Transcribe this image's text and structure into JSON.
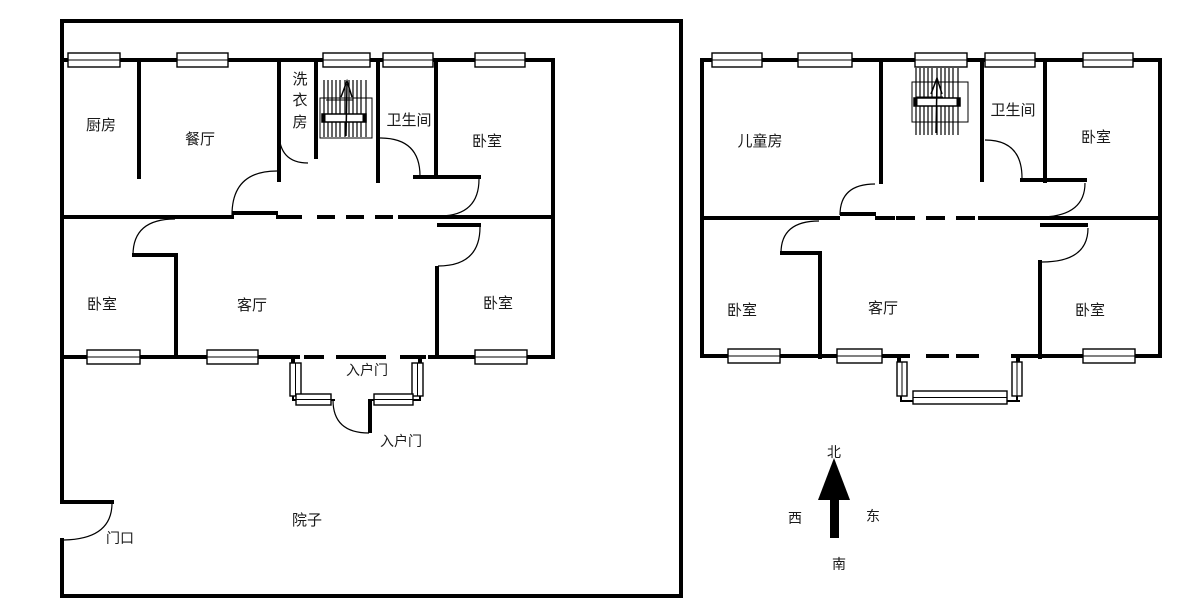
{
  "page": {
    "background": "#ffffff",
    "line_color": "#000000",
    "text_color": "#1a1a1a"
  },
  "left_plan": {
    "rooms": {
      "kitchen": "厨房",
      "dining": "餐厅",
      "laundry_chars": [
        "洗",
        "衣",
        "房"
      ],
      "bathroom": "卫生间",
      "bedroom_top": "卧室",
      "bedroom_left": "卧室",
      "living": "客厅",
      "bedroom_right": "卧室",
      "courtyard": "院子",
      "gate": "门口",
      "entrance_door_top": "入户门",
      "entrance_door_bottom": "入户门"
    }
  },
  "right_plan": {
    "rooms": {
      "children": "儿童房",
      "bathroom": "卫生间",
      "bedroom_top": "卧室",
      "bedroom_left": "卧室",
      "living": "客厅",
      "bedroom_right": "卧室"
    }
  },
  "compass": {
    "north": "北",
    "south": "南",
    "east": "东",
    "west": "西"
  }
}
